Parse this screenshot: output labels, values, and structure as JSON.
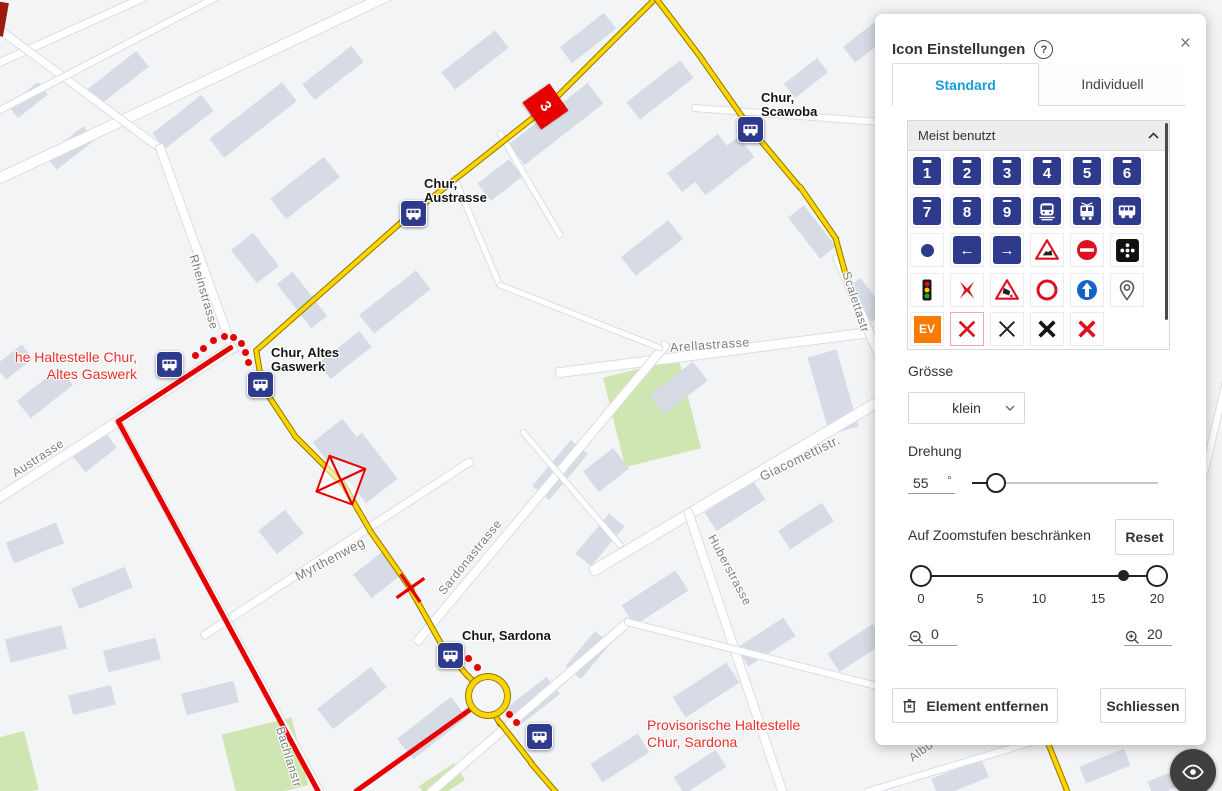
{
  "panel": {
    "title": "Icon Einstellungen",
    "help_icon": "?",
    "close_icon": "×",
    "tabs": [
      {
        "label": "Standard",
        "active": true
      },
      {
        "label": "Individuell",
        "active": false
      }
    ],
    "accordion": {
      "label": "Meist benutzt"
    },
    "icon_grid": {
      "items": [
        {
          "t": "num",
          "v": "1"
        },
        {
          "t": "num",
          "v": "2"
        },
        {
          "t": "num",
          "v": "3"
        },
        {
          "t": "num",
          "v": "4"
        },
        {
          "t": "num",
          "v": "5"
        },
        {
          "t": "num",
          "v": "6"
        },
        {
          "t": "num",
          "v": "7"
        },
        {
          "t": "num",
          "v": "8"
        },
        {
          "t": "num",
          "v": "9"
        },
        {
          "t": "train"
        },
        {
          "t": "tram"
        },
        {
          "t": "bus"
        },
        {
          "t": "dot"
        },
        {
          "t": "arrow-left",
          "v": "←"
        },
        {
          "t": "arrow-right",
          "v": "→"
        },
        {
          "t": "construction"
        },
        {
          "t": "no-entry"
        },
        {
          "t": "dots-black"
        },
        {
          "t": "traffic-light"
        },
        {
          "t": "cross-pinch"
        },
        {
          "t": "rockfall"
        },
        {
          "t": "ring"
        },
        {
          "t": "arrow-up"
        },
        {
          "t": "pin"
        },
        {
          "t": "ev",
          "v": "EV"
        },
        {
          "t": "x-red",
          "sel": true
        },
        {
          "t": "x-thin"
        },
        {
          "t": "x-black"
        },
        {
          "t": "x-redbold"
        }
      ]
    },
    "size": {
      "label": "Grösse",
      "value": "klein"
    },
    "rotation": {
      "label": "Drehung",
      "value": "55",
      "unit": "°"
    },
    "zoom_restrict": {
      "label": "Auf Zoomstufen beschränken",
      "reset_label": "Reset",
      "scale": [
        "0",
        "5",
        "10",
        "15",
        "20"
      ],
      "min_value": "0",
      "max_value": "20"
    },
    "buttons": {
      "remove": "Element entfernen",
      "close": "Schliessen"
    }
  },
  "map": {
    "colors": {
      "accent_blue": "#189cd8",
      "icon_blue": "#2e3a8c",
      "route_yellow": "#ffd400",
      "route_red": "#e60000",
      "red_text": "#e8312a",
      "building": "#d6dbe5",
      "green": "#cfe6b3"
    },
    "street_labels": [
      {
        "text": "Rheinstrasse",
        "x": 204,
        "y": 292,
        "rot": 74
      },
      {
        "text": "Austrasse",
        "x": 38,
        "y": 458,
        "rot": -33
      },
      {
        "text": "Myrthenweg",
        "x": 330,
        "y": 559,
        "rot": -28,
        "size": 13
      },
      {
        "text": "Sardonastrasse",
        "x": 470,
        "y": 557,
        "rot": -51
      },
      {
        "text": "Arellastrasse",
        "x": 710,
        "y": 345,
        "rot": -4,
        "size": 12.5
      },
      {
        "text": "Giacomettistr.",
        "x": 800,
        "y": 458,
        "rot": -26,
        "size": 13
      },
      {
        "text": "Huberstrasse",
        "x": 730,
        "y": 570,
        "rot": 62
      },
      {
        "text": "Scalettastr",
        "x": 856,
        "y": 302,
        "rot": 72
      },
      {
        "text": "Bachlanstr",
        "x": 289,
        "y": 757,
        "rot": 73
      },
      {
        "text": "Albu",
        "x": 921,
        "y": 751,
        "rot": -36
      }
    ],
    "stop_labels": [
      {
        "text": "Chur,\nScawoba",
        "x": 761,
        "y": 91
      },
      {
        "text": "Chur,\nAustrasse",
        "x": 424,
        "y": 177
      },
      {
        "text": "Chur, Altes\nGaswerk",
        "x": 271,
        "y": 346
      },
      {
        "text": "Chur, Sardona",
        "x": 462,
        "y": 629
      },
      {
        "text": "Provisorische Haltestelle\nChur, Sardona",
        "x": 647,
        "y": 717,
        "red": true
      },
      {
        "text": "he Haltestelle Chur,\nAltes Gaswerk",
        "x": 0,
        "y": 349,
        "red": true,
        "right": 137
      }
    ],
    "bus_stops": [
      [
        168,
        363
      ],
      [
        259,
        383
      ],
      [
        412,
        212
      ],
      [
        749,
        128
      ],
      [
        449,
        654
      ],
      [
        538,
        735
      ]
    ],
    "buildings": [
      [
        118,
        78,
        62,
        20,
        -38
      ],
      [
        183,
        122,
        62,
        20,
        -38
      ],
      [
        70,
        148,
        48,
        18,
        -38
      ],
      [
        28,
        100,
        38,
        16,
        -38
      ],
      [
        253,
        120,
        92,
        24,
        -38
      ],
      [
        333,
        73,
        62,
        20,
        -38
      ],
      [
        305,
        188,
        68,
        26,
        -38
      ],
      [
        475,
        60,
        68,
        22,
        -38
      ],
      [
        588,
        38,
        56,
        20,
        -38
      ],
      [
        556,
        124,
        100,
        26,
        -38
      ],
      [
        660,
        90,
        68,
        22,
        -38
      ],
      [
        722,
        166,
        62,
        26,
        -38
      ],
      [
        868,
        40,
        48,
        20,
        -38
      ],
      [
        806,
        78,
        42,
        18,
        -38
      ],
      [
        255,
        258,
        42,
        28,
        52
      ],
      [
        302,
        300,
        56,
        20,
        52
      ],
      [
        395,
        302,
        72,
        24,
        -38
      ],
      [
        345,
        355,
        52,
        20,
        -38
      ],
      [
        812,
        232,
        52,
        20,
        52
      ],
      [
        866,
        300,
        42,
        18,
        52
      ],
      [
        700,
        163,
        64,
        24,
        -38
      ],
      [
        652,
        248,
        60,
        24,
        -38
      ],
      [
        678,
        388,
        55,
        24,
        -38
      ],
      [
        833,
        392,
        30,
        80,
        -16
      ],
      [
        735,
        506,
        58,
        22,
        -33
      ],
      [
        806,
        526,
        52,
        22,
        -33
      ],
      [
        655,
        598,
        64,
        24,
        -33
      ],
      [
        606,
        470,
        38,
        26,
        -38
      ],
      [
        560,
        470,
        60,
        22,
        -50
      ],
      [
        600,
        540,
        52,
        20,
        -50
      ],
      [
        364,
        468,
        40,
        58,
        -38
      ],
      [
        338,
        444,
        38,
        34,
        -38
      ],
      [
        281,
        532,
        34,
        30,
        -38
      ],
      [
        378,
        574,
        40,
        30,
        -38
      ],
      [
        45,
        393,
        54,
        22,
        -38
      ],
      [
        14,
        362,
        34,
        18,
        -38
      ],
      [
        95,
        452,
        20,
        40,
        52
      ],
      [
        35,
        543,
        54,
        22,
        -22
      ],
      [
        102,
        588,
        58,
        22,
        -22
      ],
      [
        36,
        644,
        58,
        24,
        -14
      ],
      [
        132,
        655,
        54,
        22,
        -14
      ],
      [
        210,
        698,
        54,
        22,
        -14
      ],
      [
        92,
        700,
        44,
        20,
        -14
      ],
      [
        352,
        698,
        68,
        26,
        -38
      ],
      [
        432,
        728,
        68,
        26,
        -38
      ],
      [
        532,
        702,
        54,
        22,
        -38
      ],
      [
        620,
        758,
        56,
        22,
        -33
      ],
      [
        700,
        772,
        50,
        20,
        -33
      ],
      [
        706,
        690,
        64,
        24,
        -33
      ],
      [
        766,
        642,
        56,
        22,
        -33
      ],
      [
        856,
        648,
        54,
        22,
        -33
      ],
      [
        960,
        778,
        54,
        20,
        -22
      ],
      [
        1105,
        766,
        48,
        18,
        -22
      ],
      [
        1168,
        782,
        38,
        16,
        -22
      ],
      [
        588,
        655,
        46,
        20,
        -50
      ],
      [
        500,
        180,
        40,
        22,
        -38
      ]
    ],
    "greens": [
      [
        652,
        413,
        78,
        92,
        -14
      ],
      [
        265,
        760,
        72,
        70,
        -14
      ],
      [
        12,
        765,
        40,
        60,
        -14
      ],
      [
        442,
        783,
        42,
        20,
        -33
      ]
    ],
    "roads": [
      [
        0,
        178,
        400,
        -10,
        10
      ],
      [
        0,
        62,
        160,
        -10,
        7
      ],
      [
        -20,
        15,
        160,
        148,
        7
      ],
      [
        160,
        148,
        233,
        350,
        8
      ],
      [
        0,
        497,
        233,
        347,
        9
      ],
      [
        560,
        372,
        885,
        330,
        9
      ],
      [
        595,
        570,
        885,
        398,
        10
      ],
      [
        688,
        512,
        782,
        791,
        8
      ],
      [
        418,
        640,
        665,
        345,
        8
      ],
      [
        205,
        635,
        470,
        462,
        7
      ],
      [
        838,
        258,
        890,
        380,
        8
      ],
      [
        432,
        791,
        628,
        622,
        8
      ],
      [
        628,
        622,
        885,
        688,
        6
      ],
      [
        868,
        791,
        1030,
        742,
        6
      ],
      [
        118,
        421,
        320,
        791,
        6
      ],
      [
        455,
        178,
        500,
        285,
        5
      ],
      [
        500,
        285,
        660,
        348,
        5
      ],
      [
        695,
        108,
        880,
        122,
        6
      ],
      [
        523,
        432,
        620,
        545,
        5
      ],
      [
        0,
        110,
        230,
        -10,
        6
      ],
      [
        500,
        133,
        560,
        235,
        5
      ],
      [
        1205,
        470,
        1226,
        380,
        6
      ]
    ],
    "yellow_routes": [
      [
        [
          660,
          -8
        ],
        [
          545,
          107
        ],
        [
          412,
          212
        ],
        [
          256,
          350
        ],
        [
          262,
          385
        ],
        [
          295,
          435
        ],
        [
          342,
          482
        ],
        [
          370,
          530
        ],
        [
          412,
          590
        ],
        [
          443,
          645
        ],
        [
          468,
          675
        ],
        [
          483,
          691
        ],
        [
          500,
          722
        ],
        [
          531,
          762
        ],
        [
          556,
          791
        ]
      ],
      [
        [
          652,
          -8
        ],
        [
          702,
          58
        ],
        [
          749,
          125
        ],
        [
          800,
          186
        ],
        [
          836,
          238
        ],
        [
          847,
          278
        ]
      ],
      [
        [
          1048,
          741
        ],
        [
          1068,
          791
        ]
      ]
    ],
    "red_routes": [
      [
        [
          231,
          347
        ],
        [
          118,
          421
        ],
        [
          318,
          791
        ]
      ],
      [
        [
          472,
          708
        ],
        [
          356,
          791
        ]
      ]
    ],
    "red_dots": [
      [
        195,
        355
      ],
      [
        203,
        348
      ],
      [
        213,
        340
      ],
      [
        224,
        336
      ],
      [
        233,
        337
      ],
      [
        241,
        343
      ],
      [
        245,
        352
      ],
      [
        248,
        362
      ],
      [
        468,
        658
      ],
      [
        477,
        667
      ],
      [
        486,
        676
      ],
      [
        493,
        685
      ],
      [
        498,
        695
      ],
      [
        503,
        705
      ],
      [
        509,
        714
      ],
      [
        516,
        722
      ]
    ],
    "markers": {
      "diamond": {
        "x": 545,
        "y": 106,
        "label": "3",
        "rot": 55
      },
      "xbox": {
        "x": 340,
        "y": 480,
        "rot": 20
      },
      "xplain": {
        "x": 410,
        "y": 588,
        "rot": 10
      },
      "roundabout": {
        "x": 483,
        "y": 691
      }
    }
  }
}
